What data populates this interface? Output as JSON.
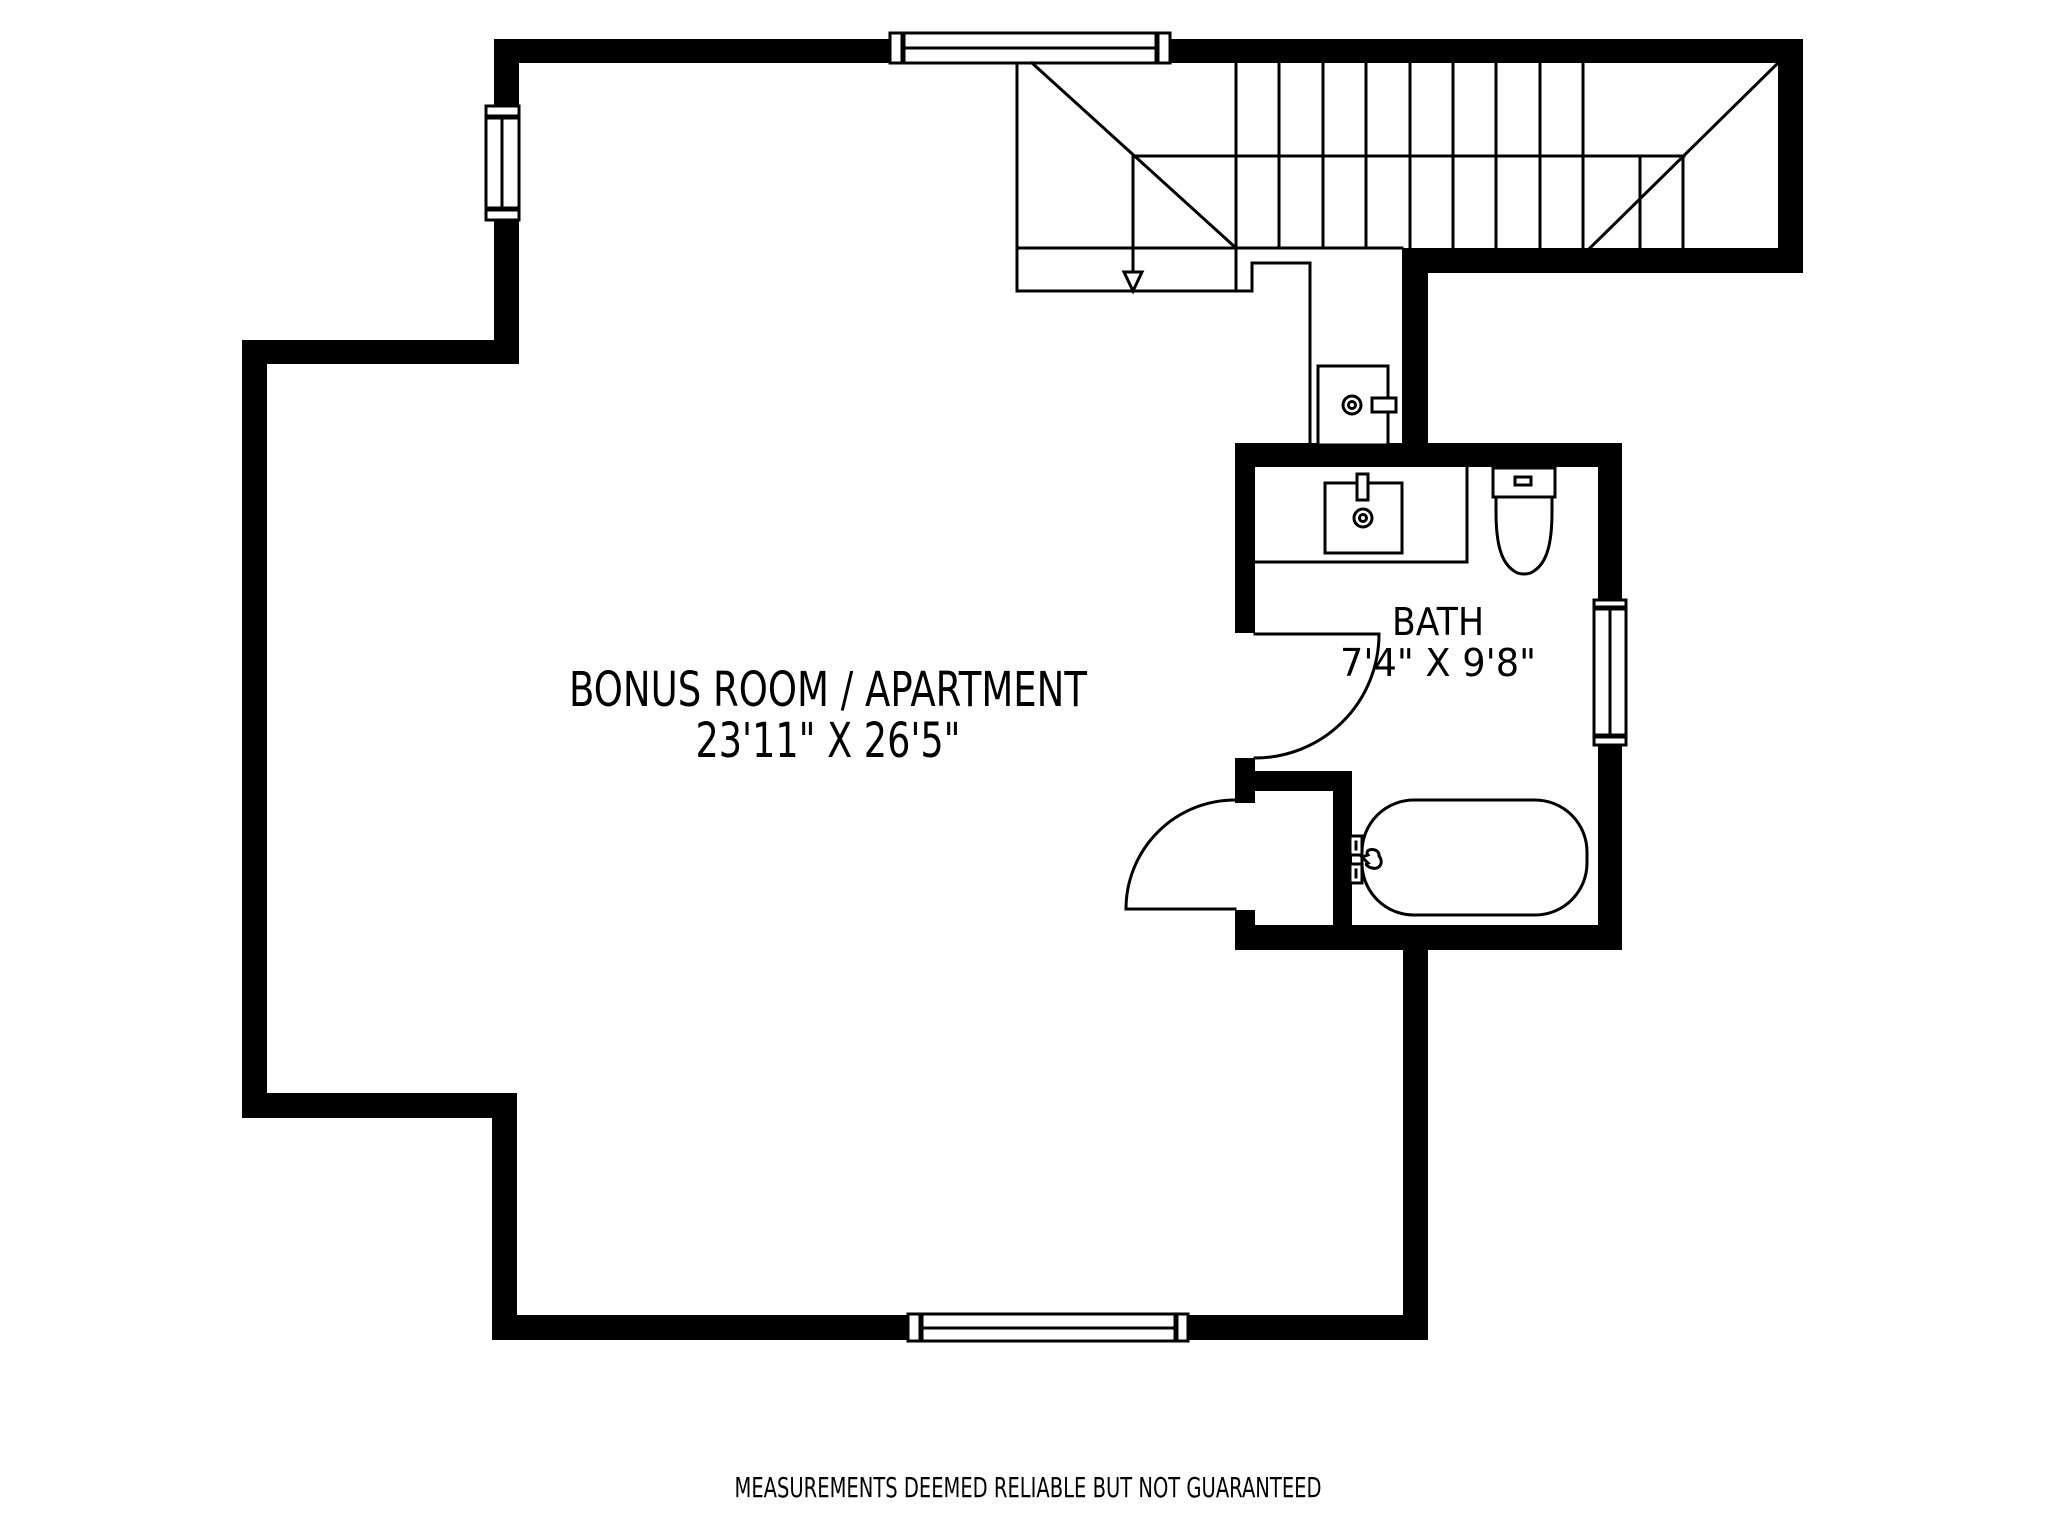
{
  "colors": {
    "wall": "#000000",
    "line": "#000000",
    "text": "#000000",
    "background": "#ffffff"
  },
  "rooms": {
    "bonus": {
      "name": "BONUS ROOM / APARTMENT",
      "dimensions": "23'11\" X 26'5\""
    },
    "bath": {
      "name": "BATH",
      "dimensions": "7'4\" X 9'8\""
    }
  },
  "footer": {
    "disclaimer": "MEASUREMENTS DEEMED RELIABLE BUT NOT GUARANTEED"
  }
}
